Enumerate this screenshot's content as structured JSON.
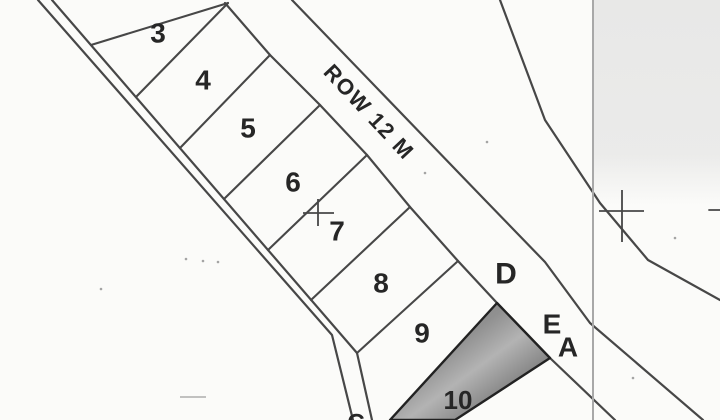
{
  "plan": {
    "kind": "cadastral-survey-sketch",
    "row_label": {
      "text": "ROW 12 M",
      "x": 369,
      "y": 112,
      "rotation": 47,
      "size": 22,
      "letter_spacing": 1.5
    },
    "lot_labels": [
      {
        "text": "3",
        "x": 158,
        "y": 33,
        "size": 28
      },
      {
        "text": "4",
        "x": 203,
        "y": 80,
        "size": 28
      },
      {
        "text": "5",
        "x": 248,
        "y": 128,
        "size": 28
      },
      {
        "text": "6",
        "x": 293,
        "y": 182,
        "size": 28
      },
      {
        "text": "7",
        "x": 337,
        "y": 231,
        "size": 28
      },
      {
        "text": "8",
        "x": 381,
        "y": 283,
        "size": 28
      },
      {
        "text": "9",
        "x": 422,
        "y": 333,
        "size": 28
      },
      {
        "text": "10",
        "x": 458,
        "y": 400,
        "size": 26
      }
    ],
    "area_labels": [
      {
        "text": "D",
        "x": 506,
        "y": 274,
        "size": 30
      },
      {
        "text": "E",
        "x": 552,
        "y": 324,
        "size": 28
      },
      {
        "text": "A",
        "x": 568,
        "y": 347,
        "size": 28
      },
      {
        "text": "C",
        "x": 356,
        "y": 423,
        "size": 24
      }
    ],
    "lines": [
      {
        "name": "road-left-edge",
        "points": [
          [
            38,
            0
          ],
          [
            332,
            335
          ],
          [
            353,
            420
          ]
        ],
        "w": 2.2,
        "c": "ink"
      },
      {
        "name": "road-right-edge",
        "points": [
          [
            52,
            0
          ],
          [
            357,
            353
          ],
          [
            372,
            420
          ]
        ],
        "w": 2.2,
        "c": "ink"
      },
      {
        "name": "lots-upper-boundary",
        "points": [
          [
            225,
            3
          ],
          [
            270,
            55
          ],
          [
            320,
            105
          ],
          [
            367,
            155
          ],
          [
            410,
            207
          ],
          [
            458,
            261
          ],
          [
            497,
            303
          ],
          [
            550,
            358
          ],
          [
            615,
            420
          ]
        ],
        "w": 2.2,
        "c": "ink"
      },
      {
        "name": "row-near-edge",
        "points": [
          [
            292,
            0
          ],
          [
            483,
            198
          ],
          [
            545,
            262
          ],
          [
            590,
            323
          ],
          [
            703,
            420
          ]
        ],
        "w": 2.2,
        "c": "ink"
      },
      {
        "name": "row-far-edge",
        "points": [
          [
            500,
            0
          ],
          [
            545,
            120
          ],
          [
            600,
            203
          ],
          [
            648,
            260
          ],
          [
            720,
            300
          ]
        ],
        "w": 2.2,
        "c": "ink"
      },
      {
        "name": "divider-lot2-lot3",
        "points": [
          [
            228,
            3
          ],
          [
            91,
            45
          ]
        ],
        "w": 2.1,
        "c": "ink"
      },
      {
        "name": "divider-lot3-lot4",
        "points": [
          [
            228,
            3
          ],
          [
            136,
            97
          ]
        ],
        "w": 2.1,
        "c": "ink"
      },
      {
        "name": "divider-lot4-lot5",
        "points": [
          [
            270,
            55
          ],
          [
            180,
            148
          ]
        ],
        "w": 2.1,
        "c": "ink"
      },
      {
        "name": "divider-lot5-lot6",
        "points": [
          [
            320,
            105
          ],
          [
            224,
            199
          ]
        ],
        "w": 2.1,
        "c": "ink"
      },
      {
        "name": "divider-lot6-lot7",
        "points": [
          [
            367,
            155
          ],
          [
            268,
            250
          ]
        ],
        "w": 2.1,
        "c": "ink"
      },
      {
        "name": "divider-lot7-lot8",
        "points": [
          [
            410,
            207
          ],
          [
            311,
            300
          ]
        ],
        "w": 2.1,
        "c": "ink"
      },
      {
        "name": "divider-lot8-lot9",
        "points": [
          [
            458,
            261
          ],
          [
            357,
            353
          ]
        ],
        "w": 2.1,
        "c": "ink"
      },
      {
        "name": "scan-fold-line",
        "points": [
          [
            593,
            0
          ],
          [
            593,
            420
          ]
        ],
        "w": 2.0,
        "c": "light"
      },
      {
        "name": "edge-tick",
        "points": [
          [
            709,
            210
          ],
          [
            720,
            210
          ]
        ],
        "w": 1.8,
        "c": "ink"
      }
    ],
    "crosses": [
      {
        "name": "survey-cross-left",
        "h": [
          [
            303,
            213
          ],
          [
            334,
            213
          ]
        ],
        "v": [
          [
            318,
            199
          ],
          [
            318,
            226
          ]
        ]
      },
      {
        "name": "survey-cross-right",
        "h": [
          [
            599,
            211
          ],
          [
            644,
            211
          ]
        ],
        "v": [
          [
            622,
            190
          ],
          [
            622,
            242
          ]
        ]
      }
    ],
    "shaded_lot": {
      "name": "lot10-shaded-parcel",
      "points": "497,303 550,358 455,420 390,420",
      "stroke_w": 2.4
    },
    "gray_wash": {
      "x": 593,
      "y": 0,
      "w": 127,
      "h": 205
    },
    "speckles": [
      [
        186,
        259
      ],
      [
        203,
        261
      ],
      [
        218,
        262
      ],
      [
        487,
        142
      ],
      [
        675,
        238
      ],
      [
        633,
        378
      ],
      [
        101,
        289
      ],
      [
        425,
        173
      ]
    ],
    "smudge": {
      "x": 180,
      "y": 396,
      "w": 26,
      "h": 2
    },
    "colors": {
      "paper": "#fbfbf9",
      "ink": "#474747",
      "ink_dark": "#222222",
      "light": "#a8a8a8",
      "wash": "#e8e8e7",
      "shade_dark": "#7d7d7d",
      "shade_mid": "#909090",
      "shade_light": "#b3b3b3",
      "text": "#262626",
      "speckle": "#8f8f8f"
    }
  }
}
